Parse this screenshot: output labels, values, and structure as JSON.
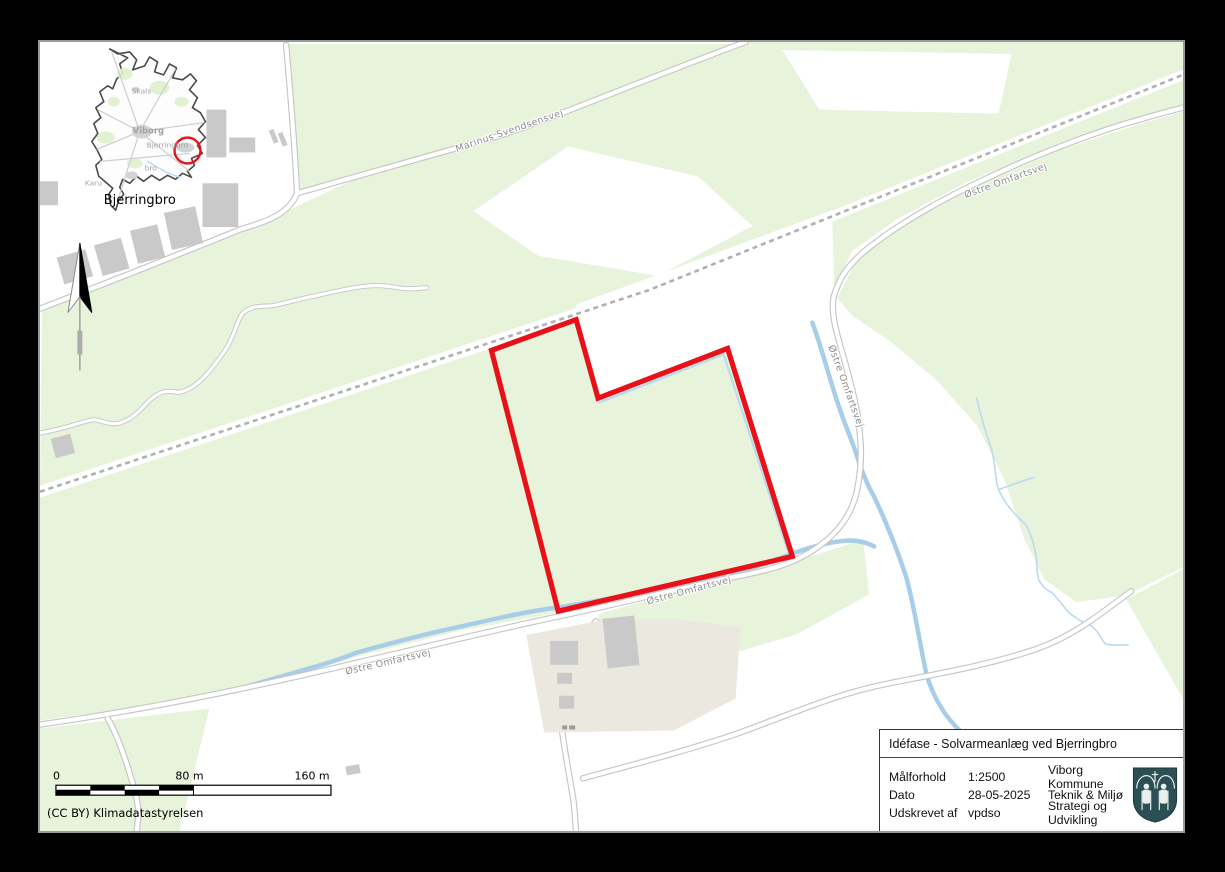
{
  "colors": {
    "page_background": "#000000",
    "field_green": "#e7f3da",
    "stream_blue": "#a8cde8",
    "stream_light_blue": "#b9daf0",
    "road_casing_gray": "#c6c6c6",
    "railway_dash_gray": "#b0b0b0",
    "building_gray": "#c9c9c9",
    "parcel_beige": "#eae8df",
    "project_outline_red": "#e8111a",
    "shield_teal": "#2b4f53"
  },
  "inset": {
    "labels": [
      {
        "text": "Skals"
      },
      {
        "text": "Viborg"
      },
      {
        "text": "Bjerringbro"
      },
      {
        "text": "bro"
      },
      {
        "text": "Karu"
      }
    ],
    "place_label": "Bjerringbro"
  },
  "map_labels": {
    "road1": "Marinus Svendsensvej",
    "road2": "Østre Omfartsvej",
    "road3": "Østre Omfartsvej",
    "road4": "Østre Omfartsvej",
    "road5": "Østre Omfartsvej"
  },
  "scalebar": {
    "tick0": "0",
    "tick1": "80 m",
    "tick2": "160 m"
  },
  "attribution": "(CC BY) Klimadatastyrelsen",
  "infobox": {
    "title": "Idéfase - Solvarmeanlæg ved Bjerringbro",
    "rows": [
      {
        "label": "Målforhold",
        "value": "1:2500",
        "org": "Viborg Kommune"
      },
      {
        "label": "Dato",
        "value": "28-05-2025",
        "org": "Teknik & Miljø"
      },
      {
        "label": "Udskrevet af",
        "value": "vpdso",
        "org": "Strategi og Udvikling"
      }
    ]
  }
}
